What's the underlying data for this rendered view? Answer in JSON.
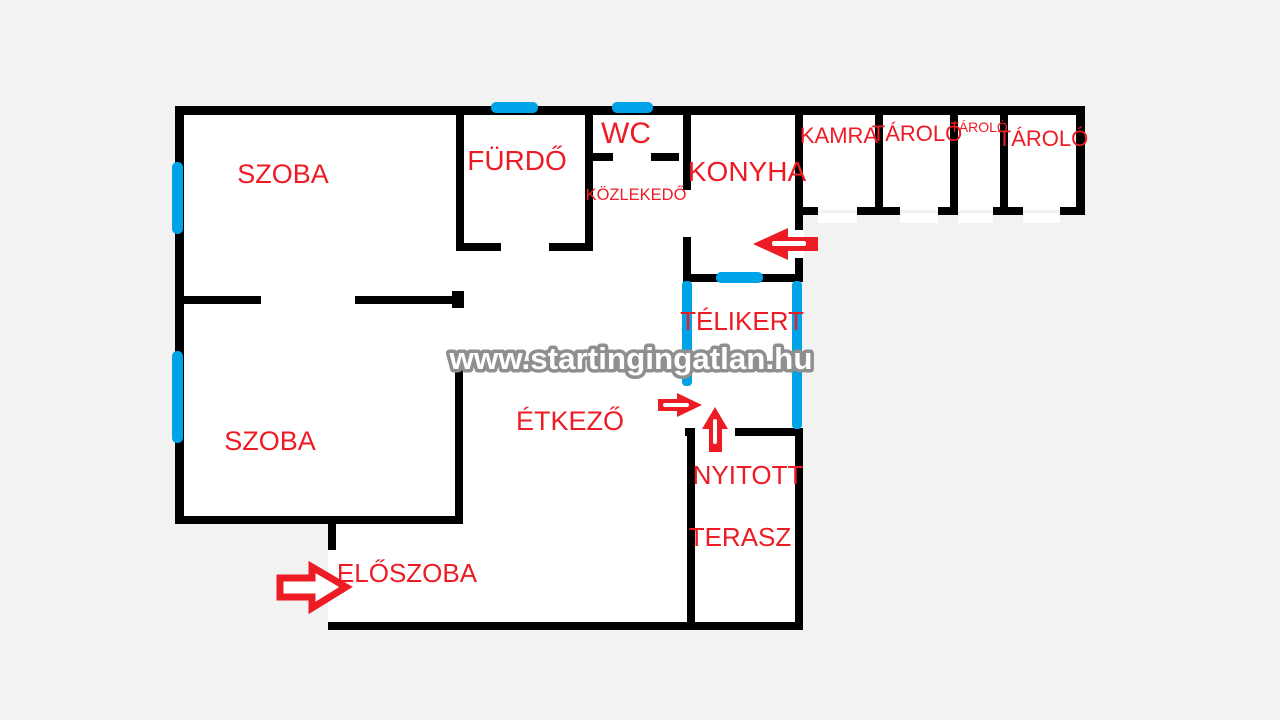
{
  "title": "Floor plan",
  "watermark": {
    "text": "www.startingingatlan.hu"
  },
  "colors": {
    "wall": "#000000",
    "window": "#00A2E8",
    "label": "#ED1C24",
    "arrow": "#ED1C24",
    "room": "#FFFFFF",
    "background": "#F2F2F2",
    "watermark_fill": "#FFFFFF",
    "watermark_outline": "#8F8F8F"
  },
  "rooms": {
    "szoba_top": "SZOBA",
    "szoba_bottom": "SZOBA",
    "furdo": "FÜRDŐ",
    "wc": "WC",
    "kozlekedo": "KÖZLEKEDŐ",
    "konyha": "KONYHA",
    "kamra": "KAMRA",
    "tarolo_1": "TÁROLÓ",
    "tarolo_2": "TÁROLÓ",
    "tarolo_3": "TÁROLÓ",
    "telikert": "TÉLIKERT",
    "etkezo": "ÉTKEZŐ",
    "nyitott": "NYITOTT",
    "terasz": "TERASZ",
    "eloszoba": "ELŐSZOBA"
  }
}
